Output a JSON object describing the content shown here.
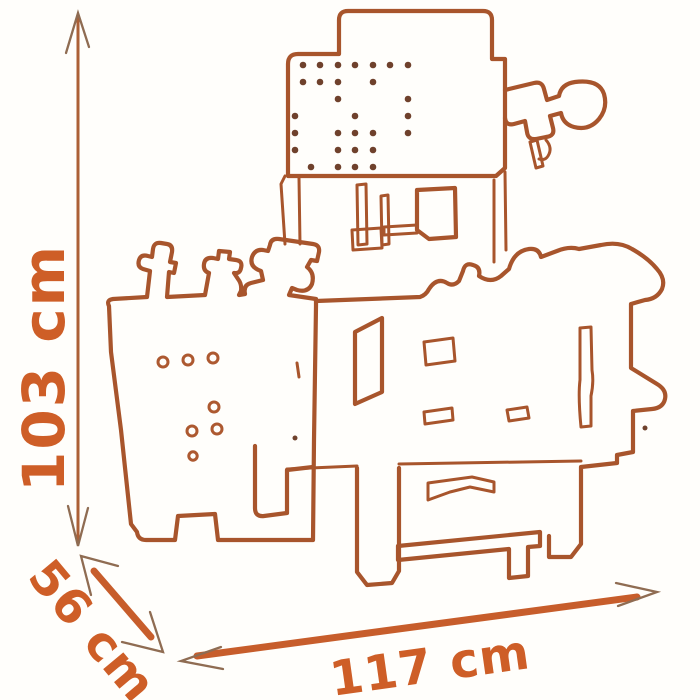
{
  "page": {
    "background_color": "#FFFEFB",
    "subject": "Toy workbench outline drawing with product dimensions"
  },
  "drawing": {
    "style": "single-line orange outline illustration",
    "line_color": "#A8552C",
    "pegboard_dot_color": "#6F412C",
    "hole_ring_color": "#AD5930"
  },
  "dimensions": {
    "text_color": "#CE5E27",
    "arrow_shaft_color": "#C75D2B",
    "arrowhead_color": "#8F6C52",
    "height": {
      "label": "103 cm",
      "value": 103,
      "unit": "cm",
      "orientation": "vertical-left"
    },
    "depth": {
      "label": "56 cm",
      "value": 56,
      "unit": "cm",
      "orientation": "diagonal-bottom-left"
    },
    "width": {
      "label": "117 cm",
      "value": 117,
      "unit": "cm",
      "orientation": "horizontal-bottom"
    }
  }
}
